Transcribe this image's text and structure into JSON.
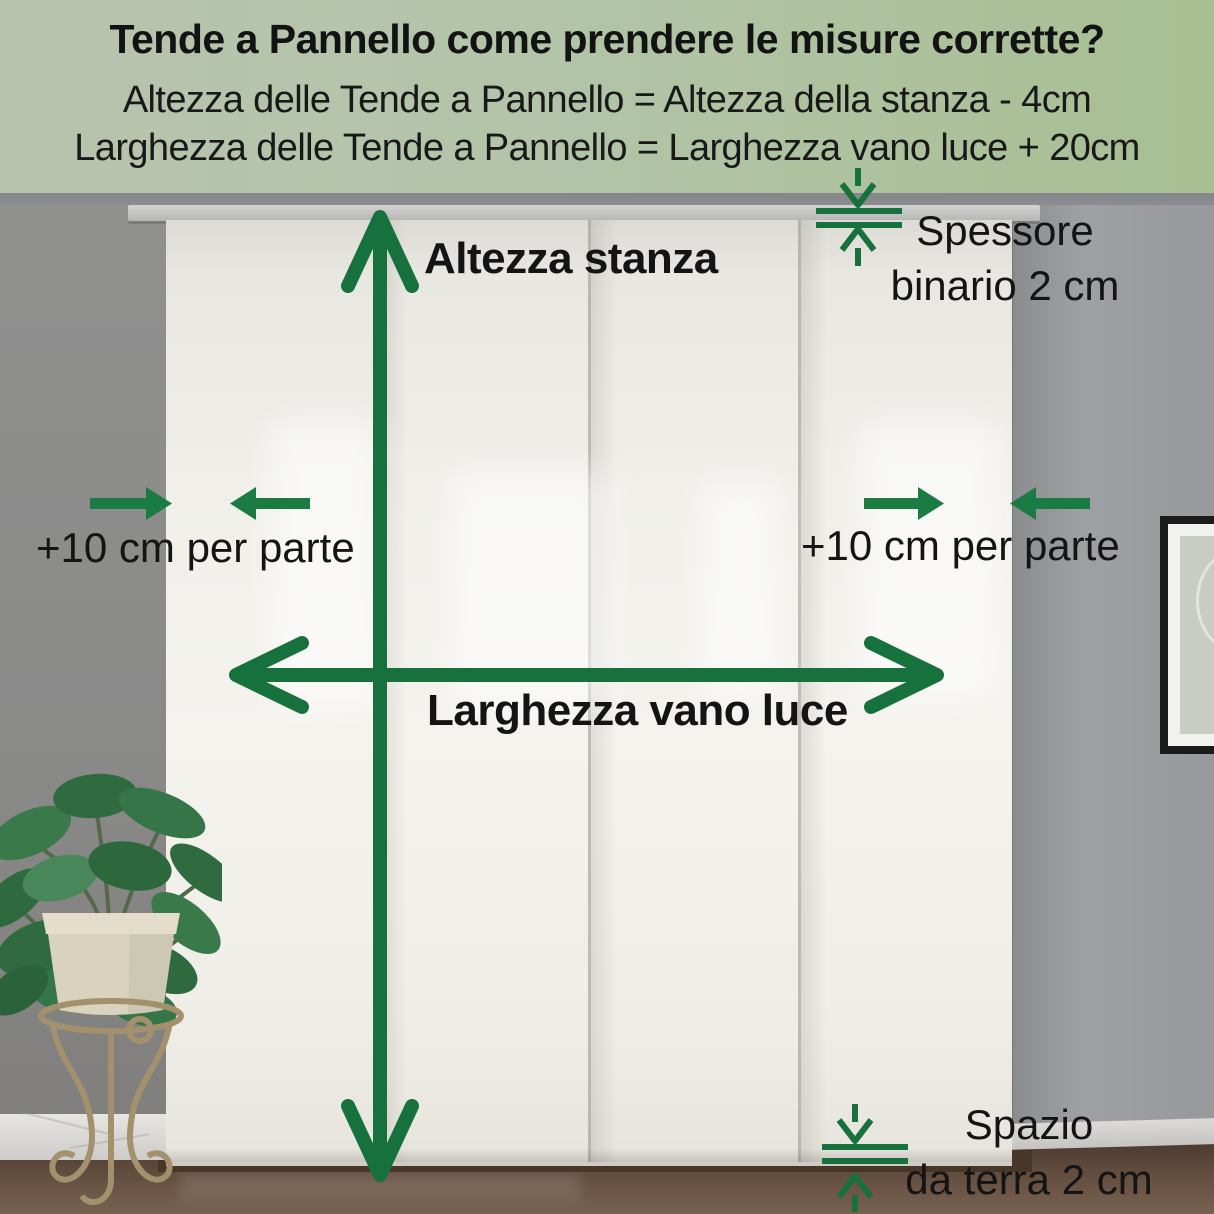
{
  "header": {
    "title": "Tende a Pannello come prendere le misure corrette?",
    "formula_height": "Altezza delle Tende a Pannello = Altezza della stanza - 4cm",
    "formula_width": "Larghezza delle Tende a Pannello = Larghezza vano luce + 20cm"
  },
  "labels": {
    "room_height": "Altezza stanza",
    "opening_width": "Larghezza vano luce",
    "left_margin": "+10 cm per parte",
    "right_margin": "+10 cm per parte",
    "rail_thickness_line1": "Spessore",
    "rail_thickness_line2": "binario 2 cm",
    "floor_gap_line1": "Spazio",
    "floor_gap_line2": "da terra 2 cm"
  },
  "colors": {
    "accent_green": "#17713c",
    "header_background": "#b3c4a8",
    "text_dark": "#161616",
    "curtain_white": "#f2f1ec",
    "wall_gray": "#98999c",
    "floor_brown": "#5d493b"
  },
  "icons": {
    "room_height_arrow": "vertical-double-arrow",
    "opening_width_arrow": "horizontal-double-arrow",
    "left_margin_arrows": "converging-horizontal-arrows",
    "right_margin_arrows": "converging-horizontal-arrows",
    "rail_thickness_indicator": "vertical-gap-arrows-with-lines",
    "floor_gap_indicator": "vertical-gap-arrows-with-lines"
  }
}
